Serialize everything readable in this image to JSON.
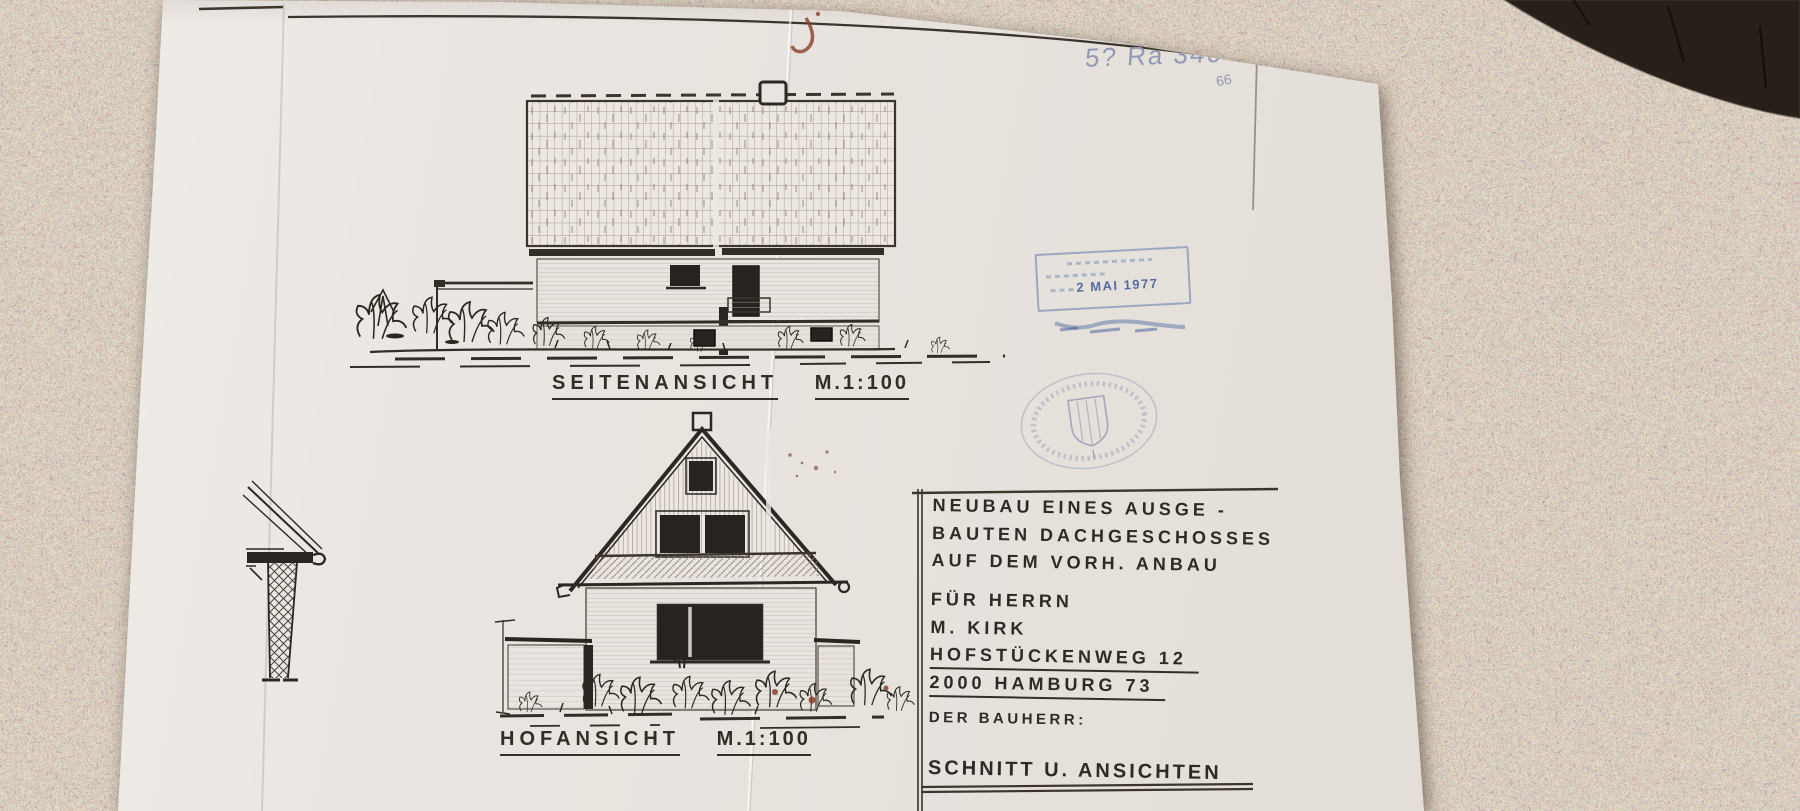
{
  "scene": {
    "background": "granite-countertop",
    "object_top_right": "dark-round-mat"
  },
  "sheet": {
    "sheet_number": "BLATT 2",
    "handwritten_reference": "5? Ra 3464",
    "handwritten_note": "66",
    "views": [
      {
        "label": "SEITENANSICHT",
        "scale": "M.1:100"
      },
      {
        "label": "HOFANSICHT",
        "scale": "M.1:100"
      }
    ],
    "title_block": {
      "project_line1": "NEUBAU EINES AUSGE -",
      "project_line2": "BAUTEN DACHGESCHOSSES",
      "project_line3": "AUF DEM VORH. ANBAU",
      "client_line1": "FÜR HERRN",
      "client_line2": "M. KIRK",
      "address_line1": "HOFSTÜCKENWEG 12",
      "address_line2": "2000 HAMBURG 73",
      "signature_label": "DER BAUHERR:",
      "sheet_title": "SCHNITT U. ANSICHTEN"
    },
    "date_stamp_text": "2 MAI 1977"
  },
  "colors": {
    "paper": "#e9e4df",
    "ink": "#332d27",
    "stamp_blue": "#4d6da8",
    "pencil_blue": "#9299b4",
    "granite_tint": "#c7b49c",
    "stain_red": "#8a3f2a"
  }
}
